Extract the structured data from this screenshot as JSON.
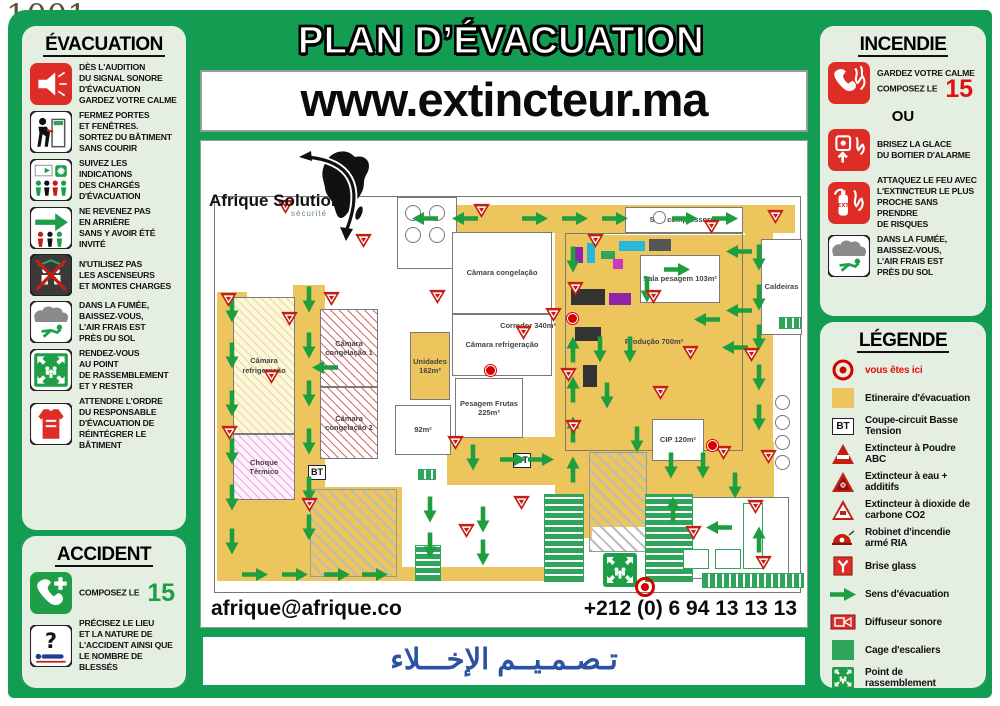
{
  "watermark": {
    "number": "1001",
    "sub": "ANNONCES"
  },
  "header": {
    "title": "PLAN D’ÉVACUATION",
    "website": "www.extincteur.ma"
  },
  "logo": {
    "name": "Afrique Solution",
    "tagline": "sécurité"
  },
  "footer": {
    "email": "afrique@afrique.co",
    "phone": "+212 (0) 6 94 13 13 13",
    "arabic": "تـصـمـيــم   الإخـــلاء"
  },
  "colors": {
    "green": "#129D52",
    "panel": "#E4EFE2",
    "red": "#DE2D26",
    "route": "#ECC65C",
    "arrow": "#1E9E3E",
    "stair": "#2FA45B",
    "arabic_blue": "#2B52A3"
  },
  "evacuation": {
    "title": "ÉVACUATION",
    "items": [
      {
        "icon": "alarm-sound",
        "text": "DÈS L'AUDITION\nDU SIGNAL SONORE\nD'ÉVACUATION\nGARDEZ VOTRE CALME"
      },
      {
        "icon": "close-doors",
        "text": "FERMEZ PORTES\nET FENÊTRES.\nSORTEZ DU BÂTIMENT\nSANS COURIR"
      },
      {
        "icon": "follow-instructions",
        "text": "SUIVEZ LES INDICATIONS\nDES CHARGÉS\nD'ÉVACUATION"
      },
      {
        "icon": "no-return",
        "text": "NE REVENEZ PAS\nEN ARRIÈRE\nSANS Y AVOIR ÉTÉ INVITÉ"
      },
      {
        "icon": "no-elevator",
        "text": "N'UTILISEZ PAS\nLES ASCENSEURS\nET MONTES CHARGES"
      },
      {
        "icon": "smoke-low",
        "text": "DANS LA FUMÉE,\nBAISSEZ-VOUS,\nL'AIR FRAIS EST\nPRÈS DU SOL"
      },
      {
        "icon": "assembly-point",
        "text": "RENDEZ-VOUS\nAU POINT\nDE RASSEMBLEMENT\nET Y RESTER"
      },
      {
        "icon": "warden-vest",
        "text": "ATTENDRE L'ORDRE\nDU RESPONSABLE\nD'ÉVACUATION DE\nRÉINTÉGRER LE BÂTIMENT"
      }
    ]
  },
  "accident": {
    "title": "ACCIDENT",
    "compose_label": "COMPOSEZ LE",
    "number": "15",
    "advise": "PRÉCISEZ LE LIEU\nET LA NATURE DE\nL'ACCIDENT AINSI QUE\nLE NOMBRE DE BLESSÉS"
  },
  "incendie": {
    "title": "INCENDIE",
    "calm_text": "GARDEZ VOTRE CALME\nCOMPOSEZ LE",
    "number": "15",
    "or_label": "OU",
    "glass_text": "BRISEZ LA GLACE\nDU BOITIER D'ALARME",
    "attack_text": "ATTAQUEZ LE FEU AVEC\nL'EXTINCTEUR LE PLUS\nPROCHE SANS PRENDRE\nDE RISQUES",
    "smoke_text": "DANS LA FUMÉE,\nBAISSEZ-VOUS,\nL'AIR FRAIS EST\nPRÈS DU SOL"
  },
  "legende": {
    "title": "LÉGENDE",
    "items": [
      {
        "icon": "you-are-here",
        "label": "vous êtes ici"
      },
      {
        "icon": "route-square",
        "label": "Etineraire d'évacuation"
      },
      {
        "icon": "bt-box",
        "label": "Coupe-circuit Basse Tension"
      },
      {
        "icon": "ext-abc",
        "label": "Extincteur à Poudre ABC"
      },
      {
        "icon": "ext-eau",
        "label": "Extincteur à eau + additifs"
      },
      {
        "icon": "ext-co2",
        "label": "Extincteur à dioxide de carbone CO2"
      },
      {
        "icon": "ria",
        "label": "Robinet d'incendie armé RIA"
      },
      {
        "icon": "brise-glass",
        "label": "Brise glass"
      },
      {
        "icon": "sens-arrow",
        "label": "Sens d'évacuation"
      },
      {
        "icon": "diffuseur",
        "label": "Diffuseur sonore"
      },
      {
        "icon": "cage-escalier",
        "label": "Cage d'escaliers"
      },
      {
        "icon": "rassemblement",
        "label": "Point de rassemblement"
      }
    ]
  },
  "plan": {
    "bt_label": "BT",
    "corridors": [
      [
        185,
        8,
        395,
        28
      ],
      [
        530,
        30,
        28,
        235
      ],
      [
        2,
        95,
        30,
        288
      ],
      [
        78,
        88,
        32,
        295
      ],
      [
        340,
        36,
        37,
        305
      ],
      [
        2,
        290,
        185,
        92
      ],
      [
        347,
        248,
        212,
        82
      ],
      [
        232,
        240,
        108,
        48
      ],
      [
        350,
        38,
        180,
        215
      ],
      [
        2,
        370,
        340,
        14
      ],
      [
        437,
        245,
        122,
        88
      ]
    ],
    "rooms": [
      [
        182,
        0,
        60,
        72,
        "plain",
        ""
      ],
      [
        18,
        100,
        62,
        137,
        "hy",
        "Câmara refrigeração"
      ],
      [
        18,
        237,
        62,
        66,
        "hp",
        "Choque Térmico"
      ],
      [
        105,
        112,
        58,
        78,
        "hr",
        "Câmara congelação 1"
      ],
      [
        105,
        190,
        58,
        72,
        "hr",
        "Câmara congelação 2"
      ],
      [
        237,
        35,
        100,
        82,
        "plain",
        "Câmara congelação"
      ],
      [
        237,
        117,
        100,
        62,
        "plain",
        "Câmara refrigeração"
      ],
      [
        195,
        135,
        40,
        68,
        "cor",
        "Unidades 162m²"
      ],
      [
        240,
        181,
        68,
        60,
        "plain",
        "Pesagem Frutas 225m²"
      ],
      [
        350,
        36,
        178,
        218,
        "none",
        "Produção 700m²"
      ],
      [
        410,
        10,
        118,
        26,
        "plain",
        "Sala compressores"
      ],
      [
        425,
        58,
        80,
        48,
        "plain",
        "Sala pesagem 103m²"
      ],
      [
        546,
        42,
        41,
        96,
        "plain",
        "Caldeiras"
      ],
      [
        437,
        222,
        52,
        42,
        "plain",
        "CIP 120m²"
      ],
      [
        180,
        208,
        56,
        50,
        "plain",
        "92m²"
      ],
      [
        462,
        300,
        112,
        82,
        "plain",
        ""
      ]
    ],
    "loose_labels": [
      {
        "x": 280,
        "y": 124,
        "w": 66,
        "t": "Corredor 340m²"
      }
    ],
    "machinery": [
      [
        358,
        50,
        10,
        16,
        "#8E24AA"
      ],
      [
        372,
        46,
        8,
        20,
        "#29B6D8"
      ],
      [
        386,
        54,
        14,
        8,
        "#2FA45B"
      ],
      [
        404,
        44,
        26,
        10,
        "#29B6D8"
      ],
      [
        434,
        42,
        22,
        12,
        "#555555"
      ],
      [
        398,
        62,
        10,
        10,
        "#C837C8"
      ],
      [
        356,
        92,
        34,
        16,
        "#333333"
      ],
      [
        394,
        96,
        22,
        12,
        "#8E24AA"
      ],
      [
        360,
        130,
        26,
        14,
        "#333333"
      ],
      [
        368,
        168,
        14,
        22,
        "#333333"
      ]
    ],
    "circles": [
      [
        190,
        8,
        16
      ],
      [
        214,
        8,
        16
      ],
      [
        190,
        30,
        16
      ],
      [
        214,
        30,
        16
      ],
      [
        560,
        198,
        15
      ],
      [
        560,
        218,
        15
      ],
      [
        560,
        238,
        15
      ],
      [
        560,
        258,
        15
      ],
      [
        438,
        14,
        13
      ]
    ],
    "stairs_v": [
      [
        200,
        348,
        24,
        34
      ],
      [
        329,
        297,
        38,
        86
      ],
      [
        430,
        297,
        46,
        86
      ]
    ],
    "stairs_h": [
      [
        487,
        376,
        100,
        13
      ],
      [
        203,
        272,
        16,
        9
      ],
      [
        564,
        120,
        20,
        10
      ]
    ],
    "docks": [
      [
        374,
        255,
        56,
        98
      ],
      [
        95,
        292,
        85,
        86
      ]
    ],
    "furniture": [
      [
        468,
        352,
        26,
        20
      ],
      [
        500,
        352,
        26,
        20
      ],
      [
        528,
        306,
        20,
        66
      ]
    ],
    "bt": [
      [
        93,
        268
      ],
      [
        298,
        256
      ]
    ],
    "arrows": [
      [
        210,
        21,
        180
      ],
      [
        250,
        21,
        180
      ],
      [
        320,
        21,
        0
      ],
      [
        360,
        21,
        0
      ],
      [
        400,
        21,
        0
      ],
      [
        470,
        21,
        0
      ],
      [
        510,
        21,
        0
      ],
      [
        544,
        60,
        90
      ],
      [
        544,
        100,
        90
      ],
      [
        544,
        140,
        90
      ],
      [
        544,
        180,
        90
      ],
      [
        544,
        220,
        90
      ],
      [
        524,
        54,
        180
      ],
      [
        524,
        113,
        180
      ],
      [
        520,
        150,
        180
      ],
      [
        17,
        112,
        90
      ],
      [
        17,
        158,
        90
      ],
      [
        17,
        206,
        90
      ],
      [
        17,
        254,
        90
      ],
      [
        17,
        300,
        90
      ],
      [
        17,
        344,
        90
      ],
      [
        94,
        102,
        90
      ],
      [
        94,
        148,
        90
      ],
      [
        94,
        196,
        90
      ],
      [
        94,
        244,
        90
      ],
      [
        94,
        292,
        90
      ],
      [
        94,
        330,
        90
      ],
      [
        358,
        62,
        90
      ],
      [
        358,
        152,
        270
      ],
      [
        358,
        192,
        270
      ],
      [
        358,
        232,
        270
      ],
      [
        358,
        272,
        270
      ],
      [
        110,
        170,
        180
      ],
      [
        40,
        377,
        0
      ],
      [
        80,
        377,
        0
      ],
      [
        122,
        377,
        0
      ],
      [
        160,
        377,
        0
      ],
      [
        215,
        312,
        90
      ],
      [
        215,
        348,
        90
      ],
      [
        268,
        322,
        90
      ],
      [
        268,
        355,
        90
      ],
      [
        258,
        260,
        90
      ],
      [
        298,
        262,
        0
      ],
      [
        326,
        262,
        0
      ],
      [
        385,
        152,
        90
      ],
      [
        415,
        152,
        90
      ],
      [
        392,
        198,
        90
      ],
      [
        432,
        92,
        90
      ],
      [
        462,
        72,
        0
      ],
      [
        492,
        122,
        180
      ],
      [
        422,
        242,
        90
      ],
      [
        456,
        268,
        90
      ],
      [
        488,
        268,
        90
      ],
      [
        520,
        288,
        90
      ],
      [
        458,
        312,
        270
      ],
      [
        504,
        330,
        180
      ],
      [
        544,
        342,
        270
      ]
    ],
    "triangles": [
      [
        62,
        2
      ],
      [
        140,
        36
      ],
      [
        258,
        6
      ],
      [
        372,
        36
      ],
      [
        488,
        22
      ],
      [
        552,
        12
      ],
      [
        352,
        84
      ],
      [
        300,
        128
      ],
      [
        345,
        170
      ],
      [
        350,
        222
      ],
      [
        66,
        114
      ],
      [
        48,
        172
      ],
      [
        6,
        228
      ],
      [
        108,
        94
      ],
      [
        214,
        92
      ],
      [
        232,
        238
      ],
      [
        86,
        300
      ],
      [
        298,
        298
      ],
      [
        430,
        92
      ],
      [
        467,
        148
      ],
      [
        437,
        188
      ],
      [
        500,
        248
      ],
      [
        532,
        302
      ],
      [
        470,
        328
      ],
      [
        243,
        326
      ],
      [
        545,
        252
      ],
      [
        528,
        150
      ],
      [
        540,
        358
      ],
      [
        330,
        110
      ],
      [
        5,
        95
      ]
    ],
    "sonore": [
      [
        270,
        168
      ],
      [
        492,
        243
      ],
      [
        352,
        116
      ]
    ],
    "assembly": {
      "x": 388,
      "y": 356
    },
    "you_are_here": {
      "x": 420,
      "y": 380
    }
  }
}
